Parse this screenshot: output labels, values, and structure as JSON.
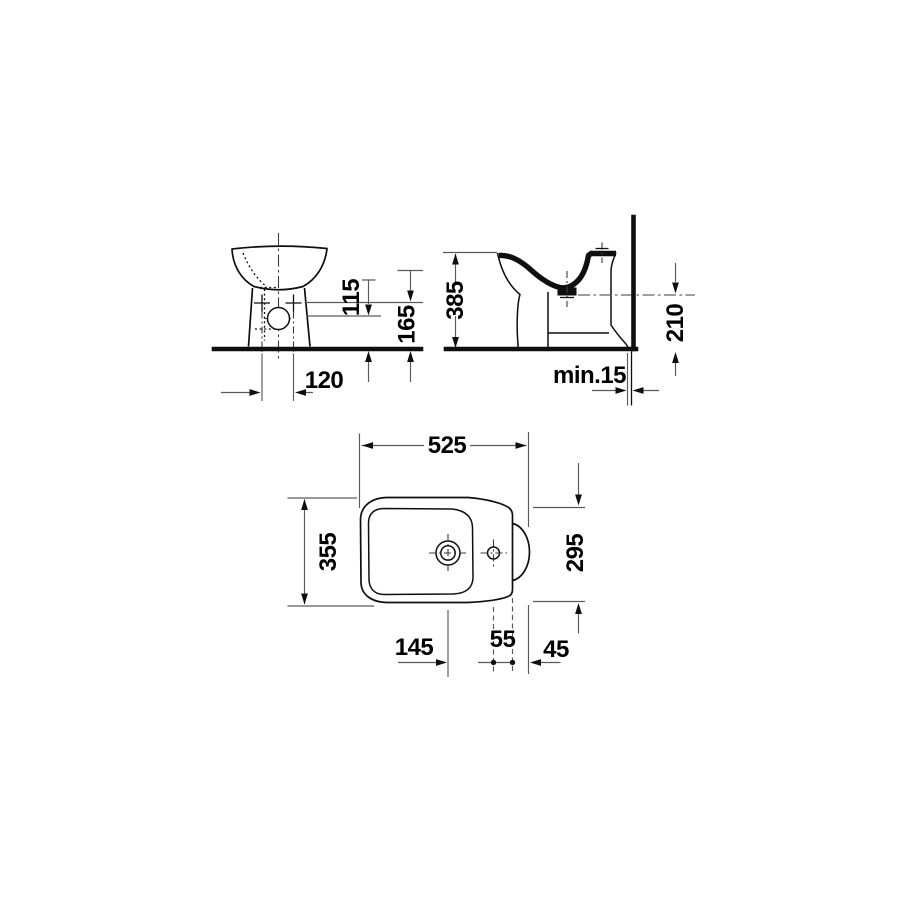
{
  "drawing": {
    "kind": "bidet-technical-dimension-drawing",
    "views": {
      "front": {
        "dims": {
          "drain_height": "115",
          "fixing_hole_height": "165",
          "fixing_hole_spacing": "120"
        }
      },
      "side": {
        "dims": {
          "total_height": "385",
          "rear_height": "210",
          "wall_clearance": "min.15"
        }
      },
      "plan": {
        "dims": {
          "length": "525",
          "width": "355",
          "rear_width": "295",
          "drain_to_tap": "145",
          "tap_to_rear_edge": "55",
          "rear_edge_to_back": "45"
        }
      }
    },
    "colors": {
      "object_line": "#0f0f0f",
      "dimension_line": "#5a5a5a",
      "centerline": "#3c3c3c",
      "text": "#000000",
      "background": "#ffffff"
    }
  }
}
